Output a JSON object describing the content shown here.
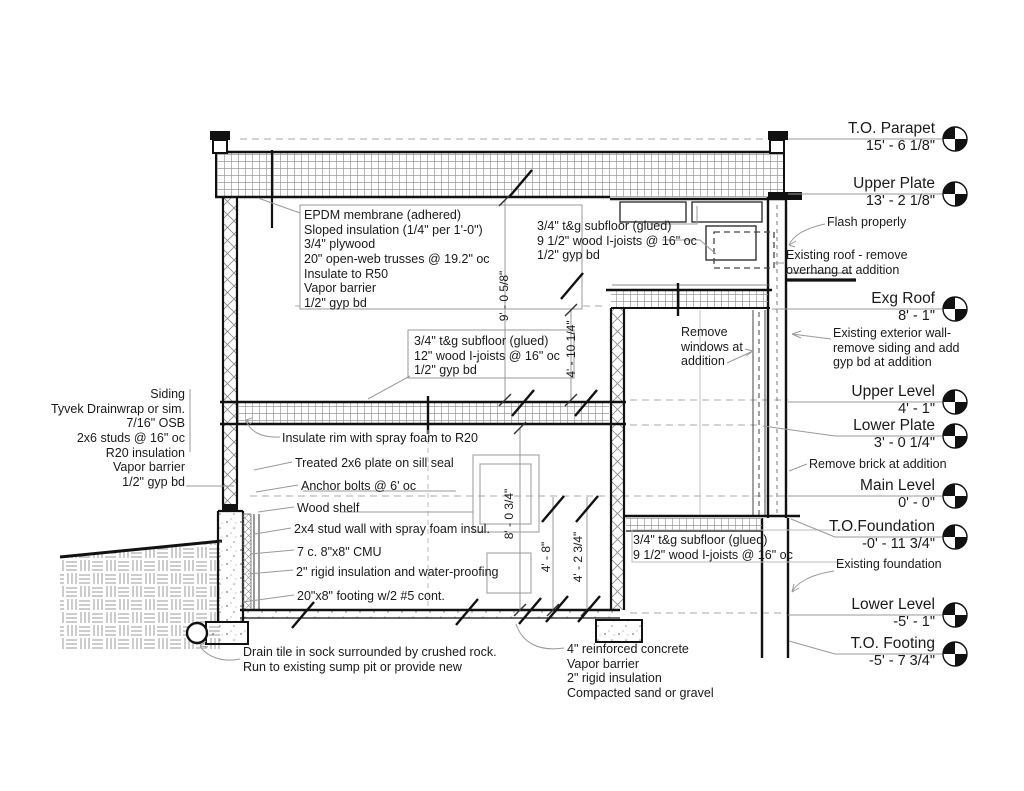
{
  "drawing_type": "Building section detail",
  "colors": {
    "ink": "#1a1a1a",
    "leader": "#999999",
    "hatch": "#8a8a8a"
  },
  "levels": [
    {
      "name": "T.O. Parapet",
      "elev": "15' - 6 1/8\""
    },
    {
      "name": "Upper Plate",
      "elev": "13' - 2 1/8\""
    },
    {
      "name": "Exg Roof",
      "elev": "8' - 1\""
    },
    {
      "name": "Upper Level",
      "elev": "4' - 1\""
    },
    {
      "name": "Lower Plate",
      "elev": "3' - 0 1/4\""
    },
    {
      "name": "Main Level",
      "elev": "0' - 0\""
    },
    {
      "name": "T.O.Foundation",
      "elev": "-0' - 11 3/4\""
    },
    {
      "name": "Lower Level",
      "elev": "-5' - 1\""
    },
    {
      "name": "T.O. Footing",
      "elev": "-5' - 7 3/4\""
    }
  ],
  "notes": {
    "left_wall": "Siding\nTyvek Drainwrap or sim.\n7/16\" OSB\n2x6 studs @ 16\" oc\nR20 insulation\nVapor barrier\n1/2\" gyp bd",
    "roof_assembly": "EPDM membrane (adhered)\nSloped insulation (1/4\" per 1'-0\")\n3/4\" plywood\n20\" open-web trusses @ 19.2\" oc\nInsulate to R50\nVapor barrier\n1/2\" gyp bd",
    "upper_floor_right": "3/4\" t&g subfloor (glued)\n9 1/2\" wood I-joists @ 16\" oc\n1/2\" gyp bd",
    "mid_floor": "3/4\" t&g subfloor (glued)\n12\" wood I-joists @ 16\" oc\n1/2\" gyp bd",
    "flash": "Flash properly",
    "existing_roof": "Existing roof - remove\noverhang at addition",
    "existing_wall": "Existing exterior wall-\nremove siding and add\ngyp bd at addition",
    "remove_windows": "Remove\nwindows at\naddition",
    "remove_brick": "Remove brick at addition",
    "insulate_rim": "Insulate rim with spray foam to R20",
    "sill_plate": "Treated 2x6 plate on sill seal",
    "anchor_bolts": "Anchor bolts @ 6' oc",
    "wood_shelf": "Wood shelf",
    "stud_wall": "2x4 stud wall with spray foam insul.",
    "cmu": "7 c. 8\"x8\" CMU",
    "rigid_insulation": "2\" rigid insulation and water-proofing",
    "footing": "20\"x8\" footing w/2 #5 cont.",
    "lower_floor_right": "3/4\" t&g subfloor (glued)\n9 1/2\" wood I-joists @ 16\" oc",
    "existing_foundation": "Existing foundation",
    "drain_tile": "Drain tile in sock surrounded by crushed rock.\nRun to existing sump pit or provide new",
    "slab": "4\" reinforced concrete\nVapor barrier\n2\" rigid insulation\nCompacted sand or gravel"
  },
  "dimensions": [
    "9' - 0 5/8\"",
    "4' - 10 1/4\"",
    "8' - 0 3/4\"",
    "4' - 8\"",
    "4' - 2 3/4\""
  ]
}
